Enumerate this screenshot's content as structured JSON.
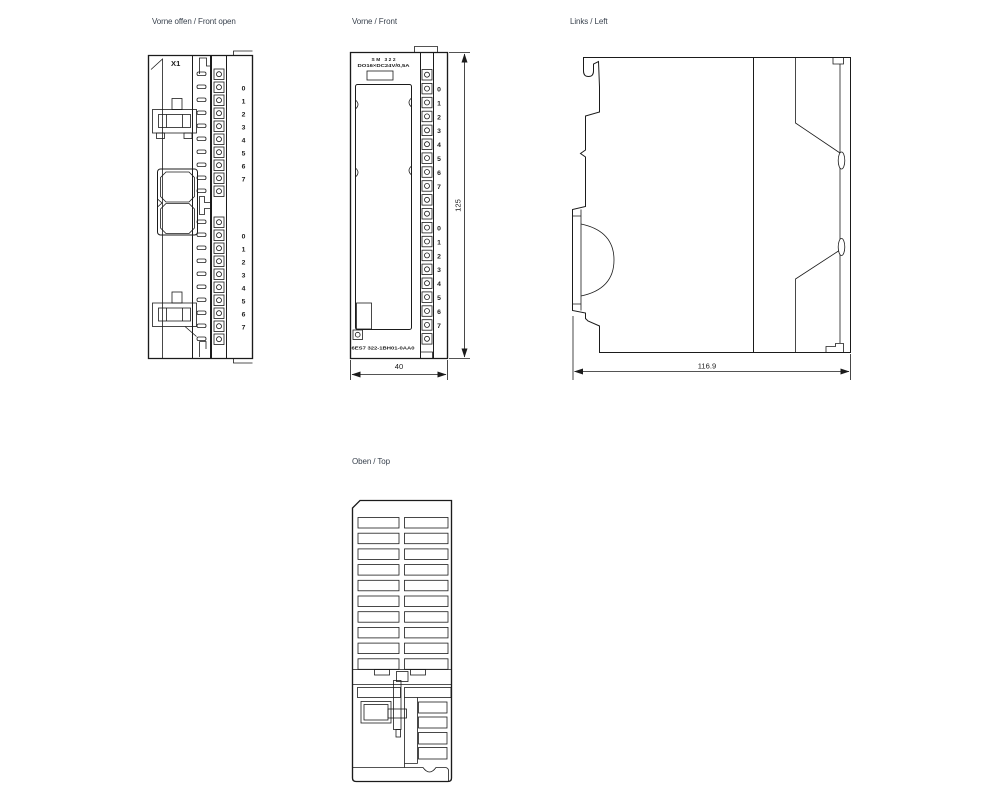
{
  "drawing": {
    "background": "#ffffff",
    "line_color": "#1b1b1b",
    "label_color": "#39424e"
  },
  "views": {
    "front_open": {
      "title": "Vorne offen / Front open",
      "connector_label": "X1"
    },
    "front": {
      "title": "Vorne / Front",
      "module_label_line1": "SM 322",
      "module_label_line2": "DO16×DC24V/0,5A",
      "order_number": "6ES7 322-1BH01-0AA0",
      "width_dim": "40",
      "height_dim": "125"
    },
    "left": {
      "title": "Links / Left",
      "depth_dim": "116.9"
    },
    "top": {
      "title": "Oben / Top"
    }
  },
  "channels": [
    "0",
    "1",
    "2",
    "3",
    "4",
    "5",
    "6",
    "7"
  ]
}
